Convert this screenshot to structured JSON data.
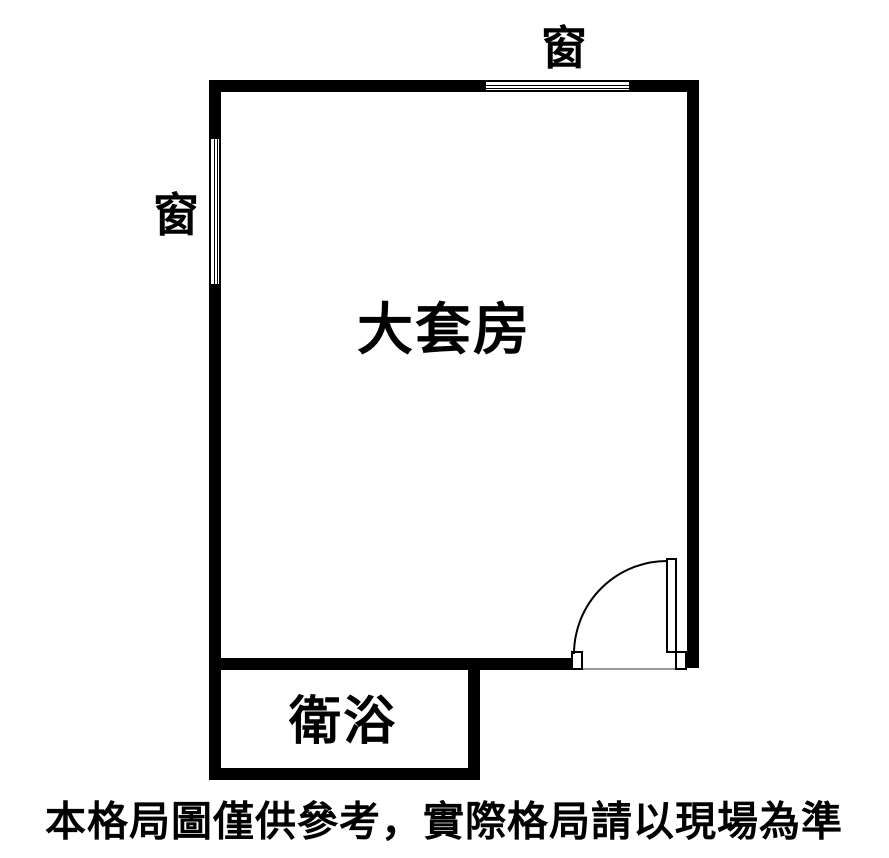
{
  "plan": {
    "labels": {
      "window_top": "窗",
      "window_left": "窗",
      "main_room": "大套房",
      "bathroom": "衛浴"
    },
    "footer": {
      "disclaimer": "本格局圖僅供參考，實際格局請以現場為準"
    },
    "colors": {
      "wall": "#000000",
      "background": "#ffffff",
      "threshold": "#9a9a9a"
    }
  }
}
